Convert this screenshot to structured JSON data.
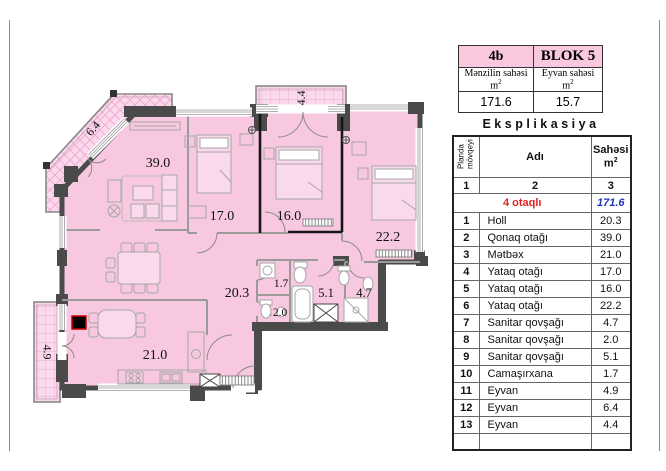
{
  "info_card": {
    "unit": "4b",
    "block": "BLOK 5",
    "apartment_area_label": "Mənzilin sahəsi",
    "balcony_area_label": "Eyvan sahəsi",
    "unit_m": "m",
    "unit_sup": "2",
    "apartment_area": "171.6",
    "balcony_area": "15.7",
    "header_bg": "#f9c8de"
  },
  "explication": {
    "title": "Eksplikasiya",
    "col_headers": {
      "position_line1": "Planda",
      "position_line2": "mövqeyi",
      "name": "Adı",
      "area_line1": "Sahəsi",
      "area_unit": "m",
      "area_sup": "2"
    },
    "index_row": [
      "1",
      "2",
      "3"
    ],
    "summary": {
      "label": "4 otaqlı",
      "value": "171.6"
    },
    "rows": [
      {
        "seq": "1",
        "name": "Holl",
        "area": "20.3"
      },
      {
        "seq": "2",
        "name": "Qonaq otağı",
        "area": "39.0"
      },
      {
        "seq": "3",
        "name": "Mətbəx",
        "area": "21.0"
      },
      {
        "seq": "4",
        "name": "Yataq otağı",
        "area": "17.0"
      },
      {
        "seq": "5",
        "name": "Yataq otağı",
        "area": "16.0"
      },
      {
        "seq": "6",
        "name": "Yataq otağı",
        "area": "22.2"
      },
      {
        "seq": "7",
        "name": "Sanitar qovşağı",
        "area": "4.7"
      },
      {
        "seq": "8",
        "name": "Sanitar qovşağı",
        "area": "2.0"
      },
      {
        "seq": "9",
        "name": "Sanitar qovşağı",
        "area": "5.1"
      },
      {
        "seq": "10",
        "name": "Camaşırxana",
        "area": "1.7"
      },
      {
        "seq": "11",
        "name": "Eyvan",
        "area": "4.9"
      },
      {
        "seq": "12",
        "name": "Eyvan",
        "area": "6.4"
      },
      {
        "seq": "13",
        "name": "Eyvan",
        "area": "4.4"
      }
    ],
    "summary_color_label": "#e3231e",
    "summary_color_value": "#2433c0"
  },
  "plan": {
    "labels": {
      "living": "39.0",
      "bedroom1": "17.0",
      "bedroom2": "16.0",
      "bedroom3": "22.2",
      "hall": "20.3",
      "laundry": "1.7",
      "wc": "2.0",
      "bath1": "5.1",
      "bath2": "4.7",
      "kitchen": "21.0",
      "balcony_diagonal": "6.4",
      "balcony_top": "4.4",
      "balcony_left": "4.9"
    },
    "colors": {
      "floor": "#f8c8e0",
      "balcony": "#fbd9ec",
      "hatch": "#efa9cd",
      "wall": "#4a4a4a",
      "shaft_red": "#cc0000"
    }
  }
}
